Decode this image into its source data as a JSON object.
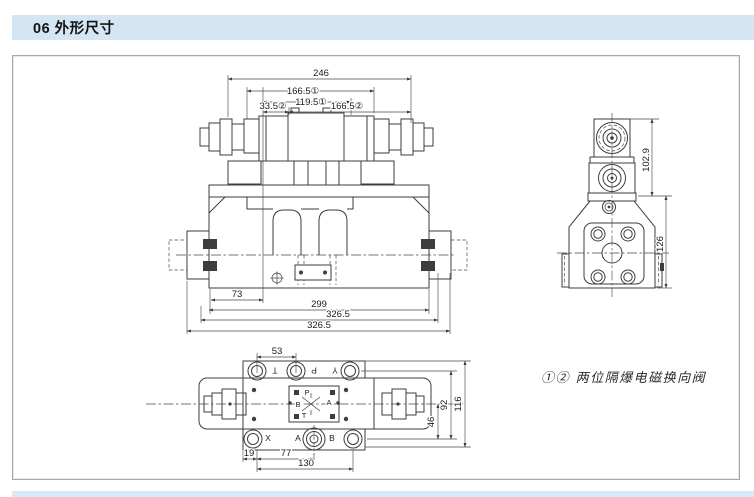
{
  "header": {
    "label": "06 外形尺寸"
  },
  "note": {
    "label": "①② 两位隔爆电磁换向阀"
  },
  "front_view": {
    "dim_246": "246",
    "dim_166_5_a": "166.5①",
    "dim_119_5": "119.5①",
    "dim_33_5": "33.5②",
    "dim_166_5_b": "166.5②",
    "dim_73": "73",
    "dim_299": "299",
    "dim_326_5_a": "326.5",
    "dim_326_5_b": "326.5"
  },
  "side_view": {
    "dim_102_9": "102.9",
    "dim_126": "126"
  },
  "bottom_view": {
    "dim_53": "53",
    "dim_19": "19",
    "dim_77": "77",
    "dim_130": "130",
    "dim_46": "46",
    "dim_92": "92",
    "dim_116": "116",
    "top_ports": {
      "t": "T",
      "p": "P",
      "y": "Y"
    },
    "bottom_ports": {
      "x": "X",
      "a": "A",
      "b": "B"
    },
    "block_ports": {
      "p": "P",
      "b": "B",
      "a": "A",
      "t": "T"
    }
  }
}
